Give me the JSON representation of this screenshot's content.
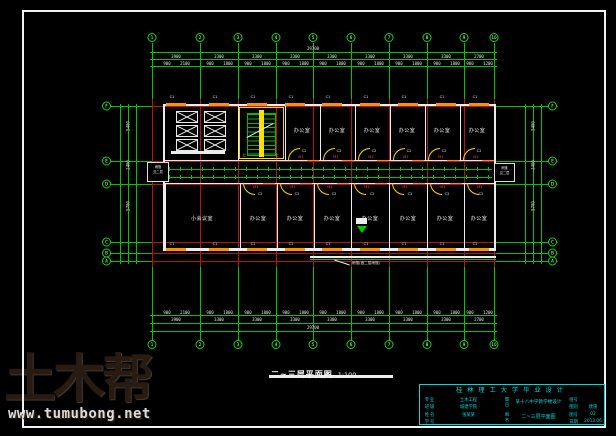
{
  "watermark": {
    "brand": "土木帮",
    "url": "www.tumubong.net"
  },
  "drawing_label": {
    "title": "二~三层平面图",
    "scale": "1:100"
  },
  "grid": {
    "columns": [
      {
        "x": 152,
        "label": "1"
      },
      {
        "x": 200,
        "label": "2"
      },
      {
        "x": 238,
        "label": "3"
      },
      {
        "x": 276,
        "label": "4"
      },
      {
        "x": 313,
        "label": "5"
      },
      {
        "x": 351,
        "label": "6"
      },
      {
        "x": 389,
        "label": "7"
      },
      {
        "x": 427,
        "label": "8"
      },
      {
        "x": 464,
        "label": "9"
      },
      {
        "x": 494,
        "label": "10"
      }
    ],
    "rows": [
      {
        "y": 106,
        "label": "F"
      },
      {
        "y": 161,
        "label": "E"
      },
      {
        "y": 184,
        "label": "D"
      },
      {
        "y": 242,
        "label": "C"
      },
      {
        "y": 253,
        "label": "B"
      },
      {
        "y": 261,
        "label": "A"
      }
    ]
  },
  "dims": {
    "top_total": "29700",
    "bottom_total": "29700",
    "bays": [
      {
        "x": 176,
        "v": "3900"
      },
      {
        "x": 219,
        "v": "3300"
      },
      {
        "x": 257,
        "v": "3300"
      },
      {
        "x": 295,
        "v": "3300"
      },
      {
        "x": 332,
        "v": "3300"
      },
      {
        "x": 370,
        "v": "3300"
      },
      {
        "x": 408,
        "v": "3300"
      },
      {
        "x": 446,
        "v": "3300"
      },
      {
        "x": 479,
        "v": "2700"
      }
    ],
    "fine": [
      {
        "x": 167,
        "v": "900"
      },
      {
        "x": 185,
        "v": "2100"
      },
      {
        "x": 210,
        "v": "900"
      },
      {
        "x": 228,
        "v": "1800"
      },
      {
        "x": 248,
        "v": "900"
      },
      {
        "x": 266,
        "v": "1800"
      },
      {
        "x": 286,
        "v": "900"
      },
      {
        "x": 304,
        "v": "1800"
      },
      {
        "x": 323,
        "v": "900"
      },
      {
        "x": 341,
        "v": "1800"
      },
      {
        "x": 361,
        "v": "900"
      },
      {
        "x": 379,
        "v": "1800"
      },
      {
        "x": 399,
        "v": "900"
      },
      {
        "x": 417,
        "v": "1800"
      },
      {
        "x": 437,
        "v": "900"
      },
      {
        "x": 455,
        "v": "1800"
      },
      {
        "x": 470,
        "v": "900"
      },
      {
        "x": 488,
        "v": "1200"
      }
    ],
    "side": [
      {
        "y": 126,
        "v": "5400"
      },
      {
        "y": 165,
        "v": "2400"
      },
      {
        "y": 206,
        "v": "5700"
      }
    ]
  },
  "rooms": {
    "top_walls": [
      {
        "x": 163
      },
      {
        "x": 238
      },
      {
        "x": 285
      },
      {
        "x": 320
      },
      {
        "x": 355
      },
      {
        "x": 390
      },
      {
        "x": 425
      },
      {
        "x": 460
      }
    ],
    "bottom_walls": [
      {
        "x": 165
      },
      {
        "x": 240
      },
      {
        "x": 277
      },
      {
        "x": 314
      },
      {
        "x": 351
      },
      {
        "x": 389
      },
      {
        "x": 427
      },
      {
        "x": 464
      }
    ],
    "top_labels": [
      {
        "x": 302,
        "v": "办公室"
      },
      {
        "x": 337,
        "v": "办公室"
      },
      {
        "x": 372,
        "v": "办公室"
      },
      {
        "x": 407,
        "v": "办公室"
      },
      {
        "x": 442,
        "v": "办公室"
      },
      {
        "x": 477,
        "v": "办公室"
      }
    ],
    "bottom_labels": [
      {
        "x": 202,
        "v": "小会议室"
      },
      {
        "x": 258,
        "v": "办公室"
      },
      {
        "x": 295,
        "v": "办公室"
      },
      {
        "x": 332,
        "v": "办公室"
      },
      {
        "x": 370,
        "v": "办公室"
      },
      {
        "x": 408,
        "v": "办公室"
      },
      {
        "x": 445,
        "v": "办公室"
      },
      {
        "x": 479,
        "v": "办公室"
      }
    ],
    "window_xs": [
      {
        "x": 166
      },
      {
        "x": 209
      },
      {
        "x": 247
      },
      {
        "x": 285
      },
      {
        "x": 322
      },
      {
        "x": 360
      },
      {
        "x": 398
      },
      {
        "x": 436
      },
      {
        "x": 469
      }
    ],
    "c1": [
      {
        "x": 172,
        "v": "C1"
      },
      {
        "x": 215,
        "v": "C1"
      },
      {
        "x": 253,
        "v": "C1"
      },
      {
        "x": 291,
        "v": "C1"
      },
      {
        "x": 328,
        "v": "C1"
      },
      {
        "x": 366,
        "v": "C1"
      },
      {
        "x": 404,
        "v": "C1"
      },
      {
        "x": 442,
        "v": "C1"
      },
      {
        "x": 475,
        "v": "C1"
      }
    ],
    "c2_top": [
      {
        "x": 304,
        "v": "C2"
      },
      {
        "x": 339,
        "v": "C2"
      },
      {
        "x": 374,
        "v": "C2"
      },
      {
        "x": 409,
        "v": "C2"
      },
      {
        "x": 444,
        "v": "C2"
      },
      {
        "x": 479,
        "v": "C2"
      }
    ],
    "c2_bottom": [
      {
        "x": 260,
        "v": "C2"
      },
      {
        "x": 297,
        "v": "C2"
      },
      {
        "x": 334,
        "v": "C2"
      },
      {
        "x": 372,
        "v": "C2"
      },
      {
        "x": 410,
        "v": "C2"
      },
      {
        "x": 447,
        "v": "C2"
      },
      {
        "x": 481,
        "v": "C2"
      }
    ],
    "arcs_top": [
      {
        "x": 288
      },
      {
        "x": 323
      },
      {
        "x": 358
      },
      {
        "x": 393
      },
      {
        "x": 428
      },
      {
        "x": 463
      }
    ],
    "arcs_bottom": [
      {
        "x": 243
      },
      {
        "x": 280
      },
      {
        "x": 317
      },
      {
        "x": 354
      },
      {
        "x": 392
      },
      {
        "x": 430
      },
      {
        "x": 467
      }
    ],
    "m1_top": [
      {
        "x": 301,
        "v": "M1"
      },
      {
        "x": 336,
        "v": "M1"
      },
      {
        "x": 371,
        "v": "M1"
      },
      {
        "x": 406,
        "v": "M1"
      },
      {
        "x": 441,
        "v": "M1"
      },
      {
        "x": 476,
        "v": "M1"
      }
    ],
    "m1_bottom": [
      {
        "x": 256,
        "v": "M1"
      },
      {
        "x": 293,
        "v": "M1"
      },
      {
        "x": 330,
        "v": "M1"
      },
      {
        "x": 367,
        "v": "M1"
      },
      {
        "x": 405,
        "v": "M1"
      },
      {
        "x": 443,
        "v": "M1"
      },
      {
        "x": 480,
        "v": "M1"
      }
    ],
    "corrwin_top": [
      {
        "x": 307
      },
      {
        "x": 342
      },
      {
        "x": 377
      },
      {
        "x": 412
      },
      {
        "x": 447
      },
      {
        "x": 482
      }
    ],
    "corrwin_bottom": [
      {
        "x": 263
      },
      {
        "x": 300
      },
      {
        "x": 337
      },
      {
        "x": 375
      },
      {
        "x": 413
      },
      {
        "x": 450
      }
    ],
    "stalls": [
      {
        "x": 176,
        "y": 111
      },
      {
        "x": 204,
        "y": 111
      },
      {
        "x": 176,
        "y": 125
      },
      {
        "x": 204,
        "y": 125
      },
      {
        "x": 176,
        "y": 139
      },
      {
        "x": 204,
        "y": 139
      }
    ]
  },
  "annotations": {
    "up": "上",
    "end_box_line1": "雨篷",
    "end_box_line2": "见二层",
    "canopy": "雨篷(做二层雨篷)"
  },
  "titleblock": {
    "header": "桂林理工大学毕业设计",
    "left_rows": [
      {
        "y": 395.5,
        "label": "专业",
        "value": "土木工程"
      },
      {
        "y": 403,
        "label": "班级",
        "value": "城建学院"
      },
      {
        "y": 410.5,
        "label": "姓名",
        "value": "张某某"
      },
      {
        "y": 418,
        "label": "学号",
        "value": ""
      }
    ],
    "mid": {
      "tag1": "题目",
      "cell1": "某十八中学教学楼设计",
      "tag2": "图名",
      "cell2": "二~三层平面图"
    },
    "right_rows": [
      {
        "y": 395.5,
        "label": "组号",
        "value": ""
      },
      {
        "y": 403,
        "label": "图别",
        "value": "建施"
      },
      {
        "y": 410.5,
        "label": "图号",
        "value": "02"
      },
      {
        "y": 418,
        "label": "日期",
        "value": "2013.06"
      }
    ]
  }
}
